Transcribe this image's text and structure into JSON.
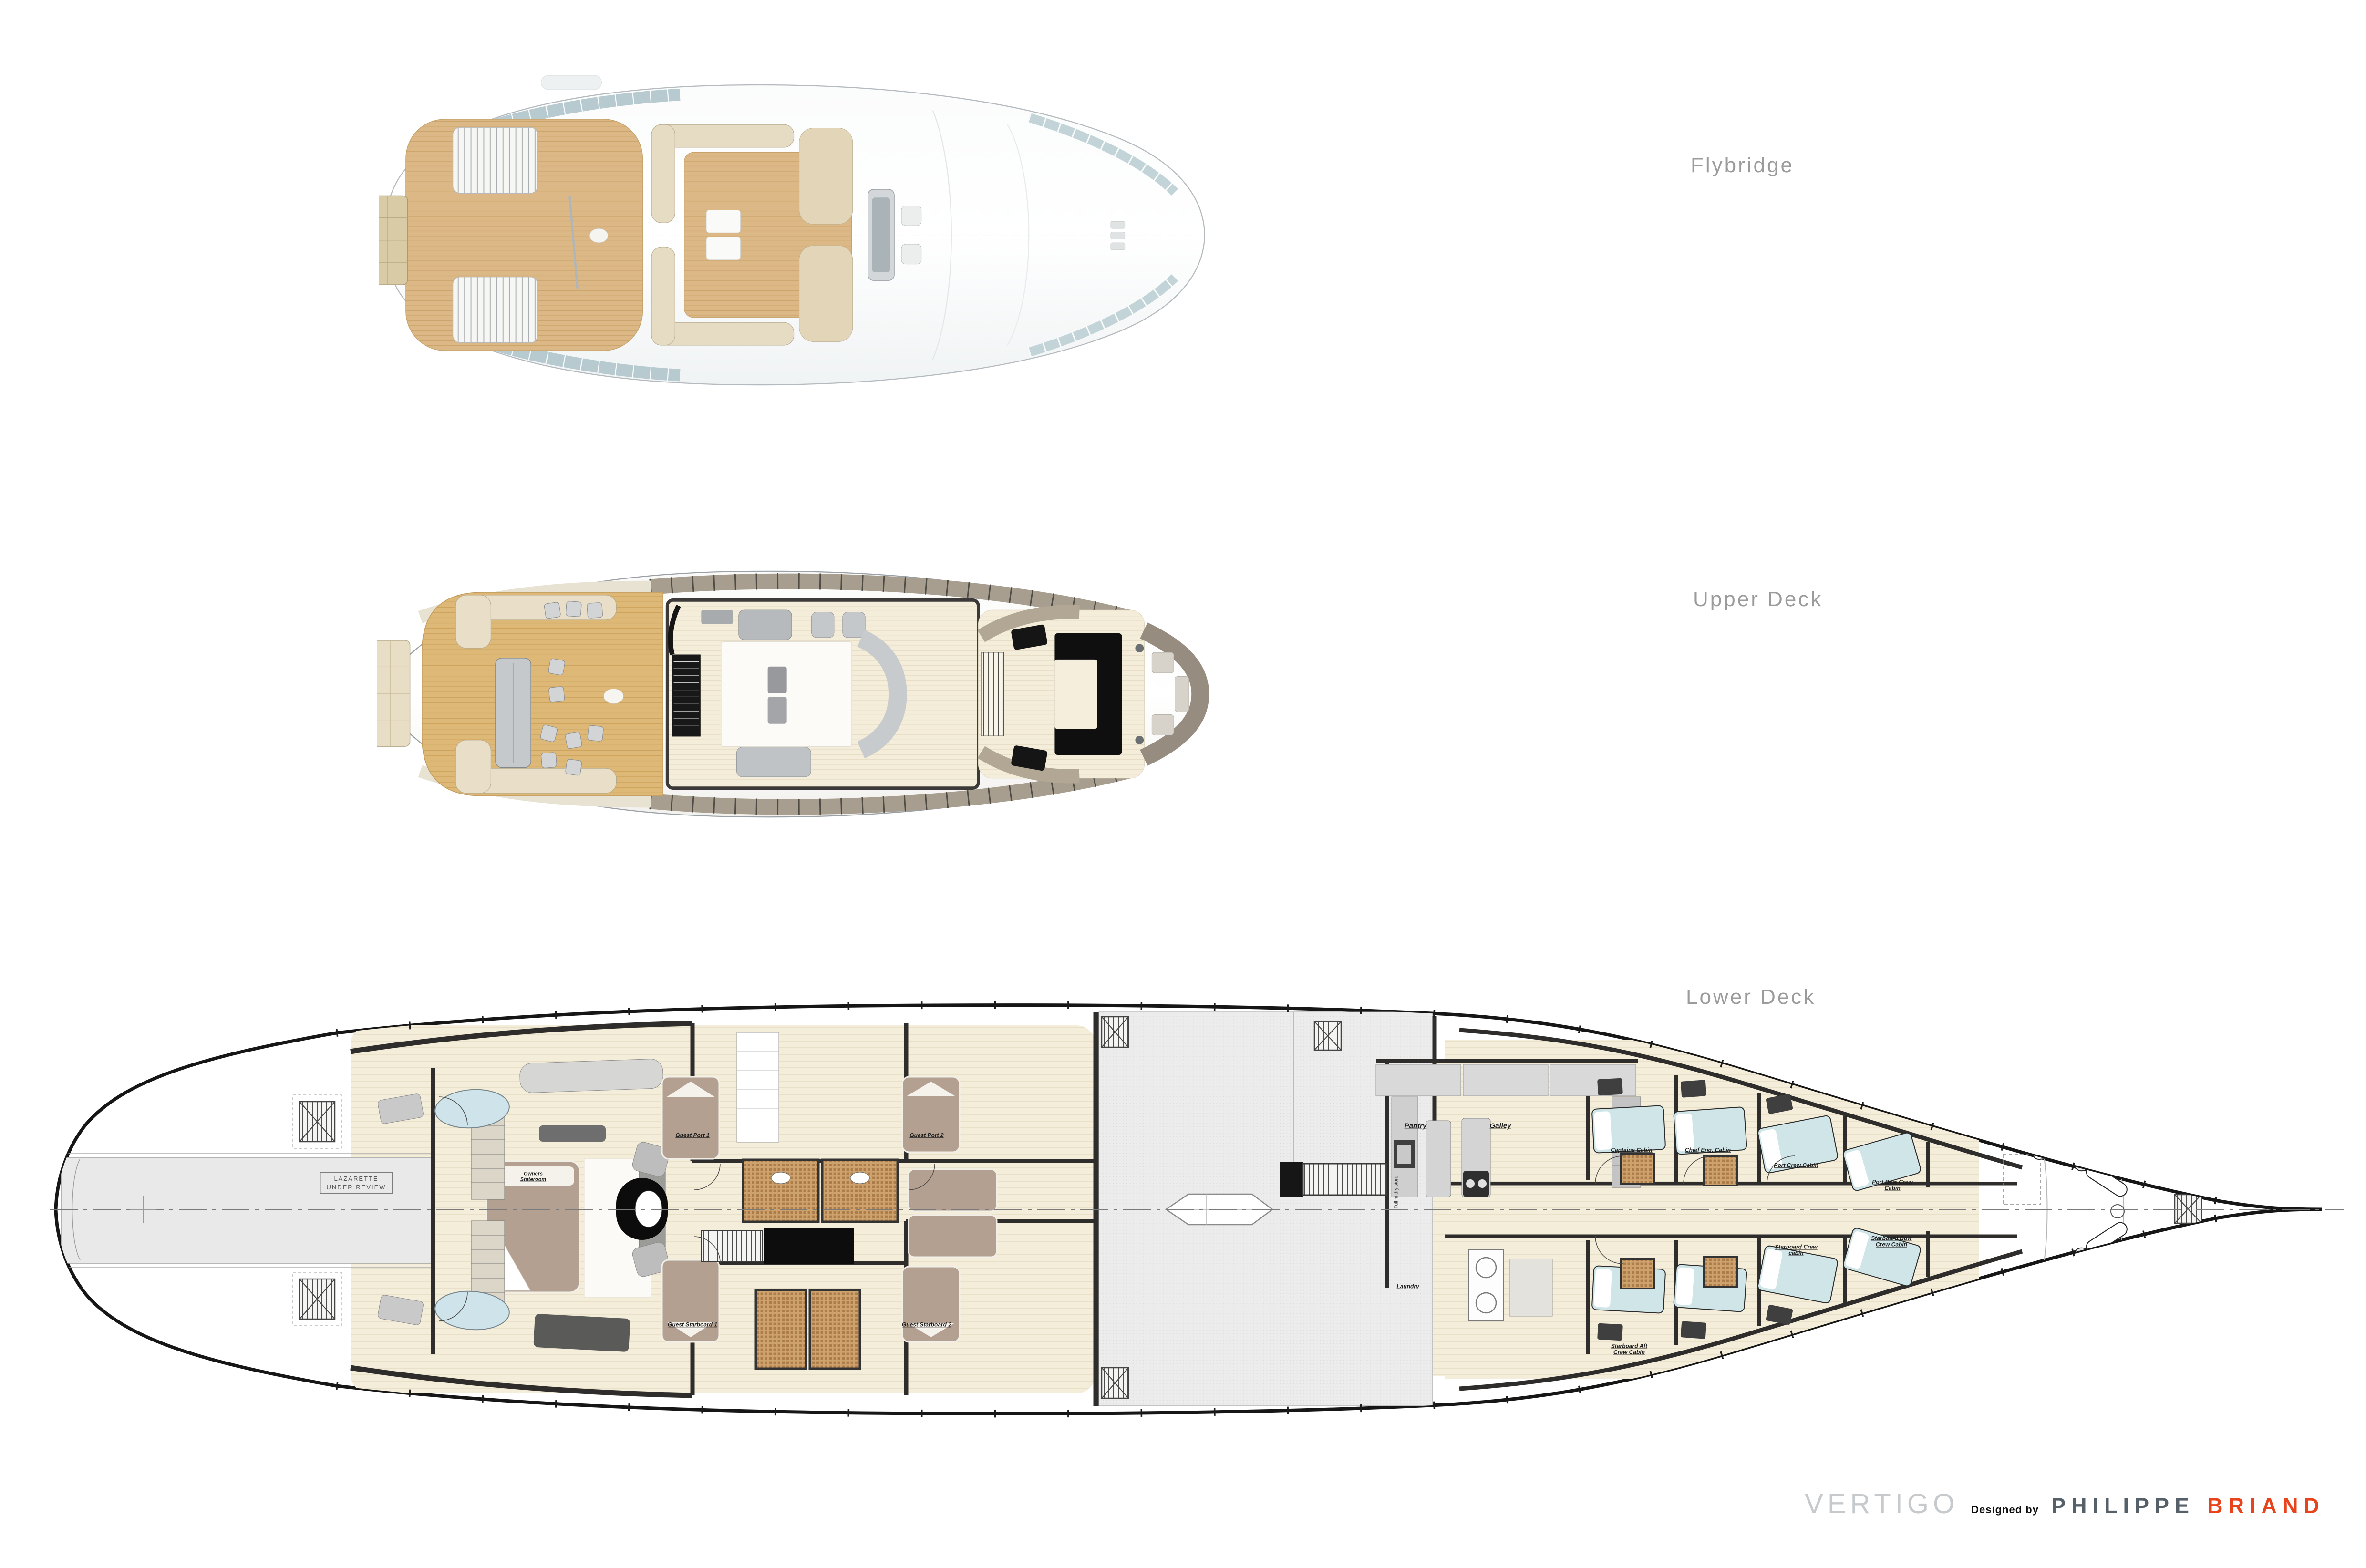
{
  "titles": {
    "flybridge": "Flybridge",
    "upper": "Upper Deck",
    "lower": "Lower Deck"
  },
  "footer": {
    "brand": "VERTIGO",
    "designed_by": "Designed by",
    "designer_first": "PHILIPPE",
    "designer_last": "BRIAND"
  },
  "colors": {
    "accent": "#e8441c",
    "designer_gray": "#566069",
    "brand_gray": "#c7cacc",
    "deck_label_gray": "#9b9b9b",
    "hull_line": "#161616",
    "wood_deck": "#dcb775",
    "cream_floor": "#f4edda",
    "teal_bed": "#cfe5e8",
    "taupe_bed": "#b3a090",
    "lazarette_gray": "#e9e9e9",
    "glass_band": "#b7cad0"
  },
  "lower_deck": {
    "notice": "LAZARETTE\nUNDER REVIEW",
    "rooms": [
      {
        "id": "owners-stateroom",
        "label": "Owners\nStateroom"
      },
      {
        "id": "guest-port-1",
        "label": "Guest Port 1"
      },
      {
        "id": "guest-port-2",
        "label": "Guest Port 2"
      },
      {
        "id": "guest-starboard-1",
        "label": "Guest Starboard 1"
      },
      {
        "id": "guest-starboard-2",
        "label": "Guest Starboard 2"
      },
      {
        "id": "pantry",
        "label": "Pantry"
      },
      {
        "id": "galley",
        "label": "Galley"
      },
      {
        "id": "full-ht-dry-store",
        "label": "Full ht dry store"
      },
      {
        "id": "laundry",
        "label": "Laundry"
      },
      {
        "id": "captains-cabin",
        "label": "Captains Cabin"
      },
      {
        "id": "chief-eng-cabin",
        "label": "Chief Eng. Cabin"
      },
      {
        "id": "port-crew-cabin",
        "label": "Port Crew Cabin"
      },
      {
        "id": "port-bow-crew-cabin",
        "label": "Port Bow Crew\nCabin"
      },
      {
        "id": "starboard-crew-cabin",
        "label": "Starboard Crew\ncabin"
      },
      {
        "id": "starboard-bow-crew-cabin",
        "label": "Starboard Bow\nCrew Cabin"
      },
      {
        "id": "starboard-aft-crew-cabin",
        "label": "Starboard Aft\nCrew Cabin"
      }
    ]
  }
}
